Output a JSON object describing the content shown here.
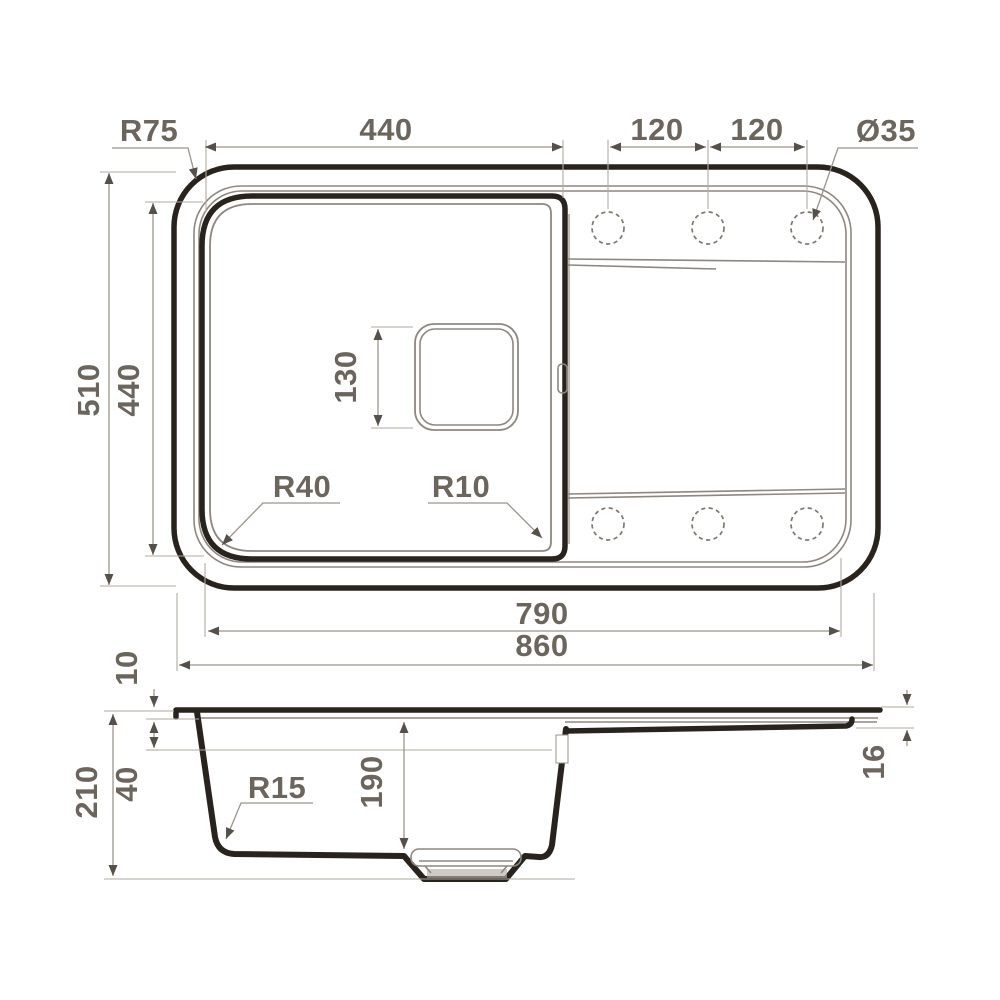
{
  "title": "Kitchen sink dimension drawing (top view and section view)",
  "top_view": {
    "radius_outer_corner": "R75",
    "bowl_width": "440",
    "hole_spacing_1": "120",
    "hole_spacing_2": "120",
    "hole_diameter": "Ø35",
    "overall_height": "510",
    "bowl_height": "440",
    "drain_square": "130",
    "radius_bowl_left": "R40",
    "radius_bowl_right": "R10",
    "inner_width": "790",
    "overall_width": "860"
  },
  "side_view": {
    "rim_height": "10",
    "ledge_depth": "40",
    "overall_depth": "210",
    "radius_bottom": "R15",
    "bowl_depth": "190",
    "edge_thickness": "16"
  },
  "colors": {
    "outline_dark": "#29231e",
    "outline_thin": "#8e8780",
    "dimension_line": "#9b948c",
    "dimension_text": "#6b655e",
    "background": "#ffffff"
  }
}
